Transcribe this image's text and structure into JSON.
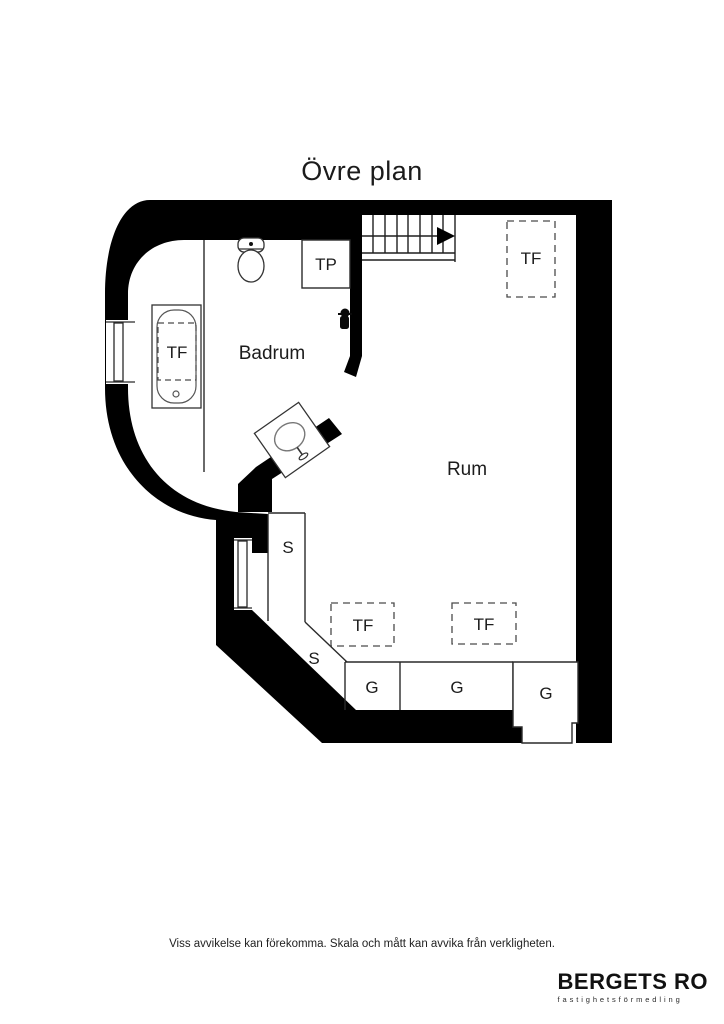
{
  "page": {
    "title": "Övre plan"
  },
  "plan": {
    "room_labels": {
      "bathroom": "Badrum",
      "main_room": "Rum"
    },
    "zone_labels": {
      "tp": "TP",
      "tf_bathtub": "TF",
      "tf_top_right": "TF",
      "tf_bottom_left": "TF",
      "tf_bottom_right": "TF",
      "s_upper": "S",
      "s_lower": "S",
      "g_left": "G",
      "g_middle": "G",
      "g_right": "G"
    }
  },
  "footer": {
    "disclaimer": "Viss avvikelse kan förekomma. Skala och mått kan avvika från verkligheten.",
    "brand": {
      "name": "BERGETS RO",
      "tagline": "fastighetsförmedling"
    }
  }
}
